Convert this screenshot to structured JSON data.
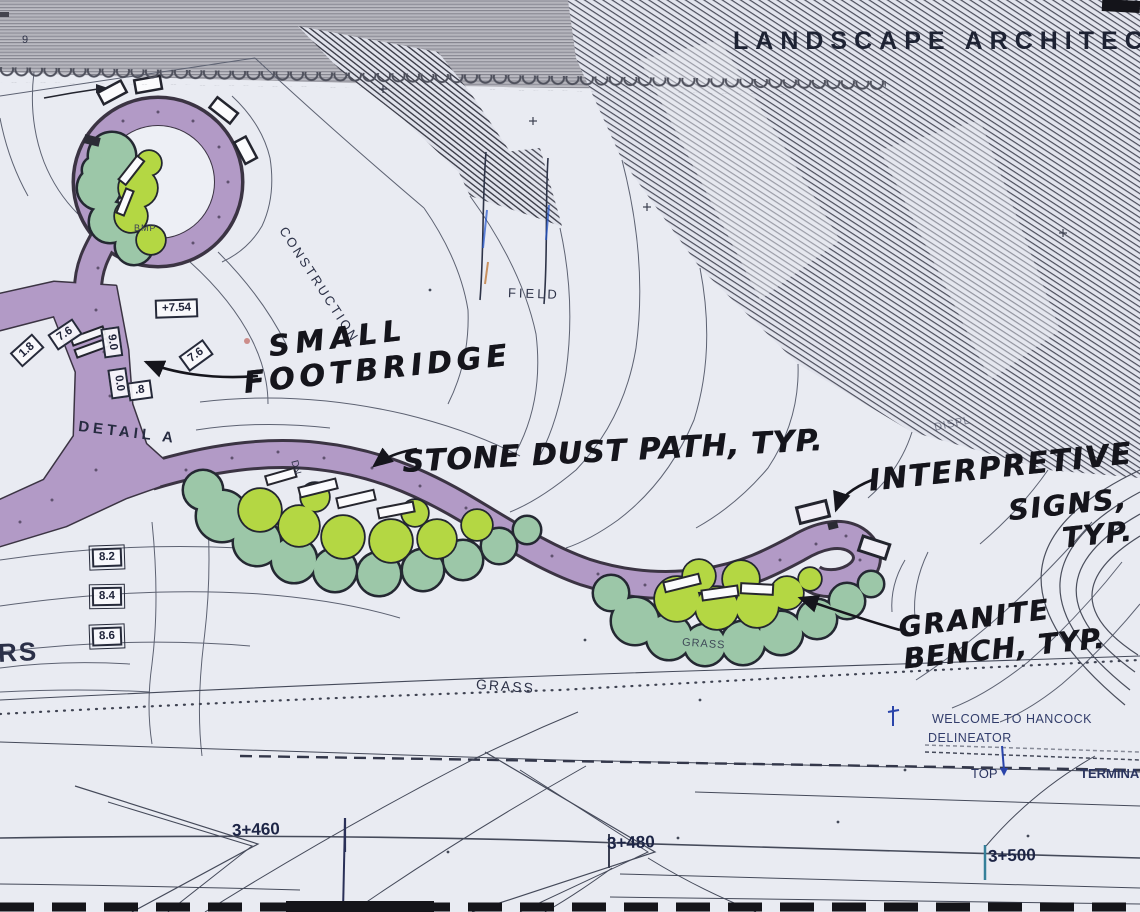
{
  "meta": {
    "description": "Photograph of a landscape architecture site plan with hand-drawn design markup"
  },
  "title": "LANDSCAPE ARCHITECTU",
  "handwritten": {
    "footbridge": [
      "SMALL",
      "FOOTBRIDGE"
    ],
    "stone_dust": "STONE DUST PATH, TYP.",
    "interpretive": [
      "INTERPRETIVE",
      "SIGNS,",
      "TYP."
    ],
    "granite": [
      "GRANITE",
      "BENCH, TYP."
    ]
  },
  "plan_labels": {
    "construction": "CONSTRUCTION",
    "field": "FIELD",
    "grass_main": "GRASS",
    "grass_right": "GRASS",
    "detail": "DETAIL A",
    "rs": "RS",
    "bmp": "BMP",
    "dn": "DN",
    "displ": "DISPL",
    "welcome": "WELCOME TO HANCOCK",
    "delineator": "DELINEATOR",
    "top": "TOP",
    "terminal": "TERMINA",
    "small_nine": "9"
  },
  "stations": [
    {
      "label": "3+460"
    },
    {
      "label": "3+480"
    },
    {
      "label": "3+500"
    }
  ],
  "elevations": [
    {
      "label": "+7.54"
    },
    {
      "label": "7.6"
    },
    {
      "label": "1.8"
    },
    {
      "label": ".8"
    },
    {
      "label": "9.0"
    },
    {
      "label": "0.0"
    },
    {
      "label": "7.6"
    },
    {
      "label": "8.2"
    },
    {
      "label": "8.4"
    },
    {
      "label": "8.6"
    }
  ],
  "colors": {
    "paper": "#e9ebf2",
    "path_purple": "#b29ac6",
    "path_outline": "#3b3443",
    "tree_teal": "#9cc7a8",
    "tree_yellow": "#b4d743",
    "ink_plan": "#2d3248",
    "ink_hand": "#15151c",
    "station_blue": "#1d2546",
    "hatch_gray": "#83838d",
    "accent_blue": "#2a44aa",
    "accent_teal": "#35809a"
  }
}
